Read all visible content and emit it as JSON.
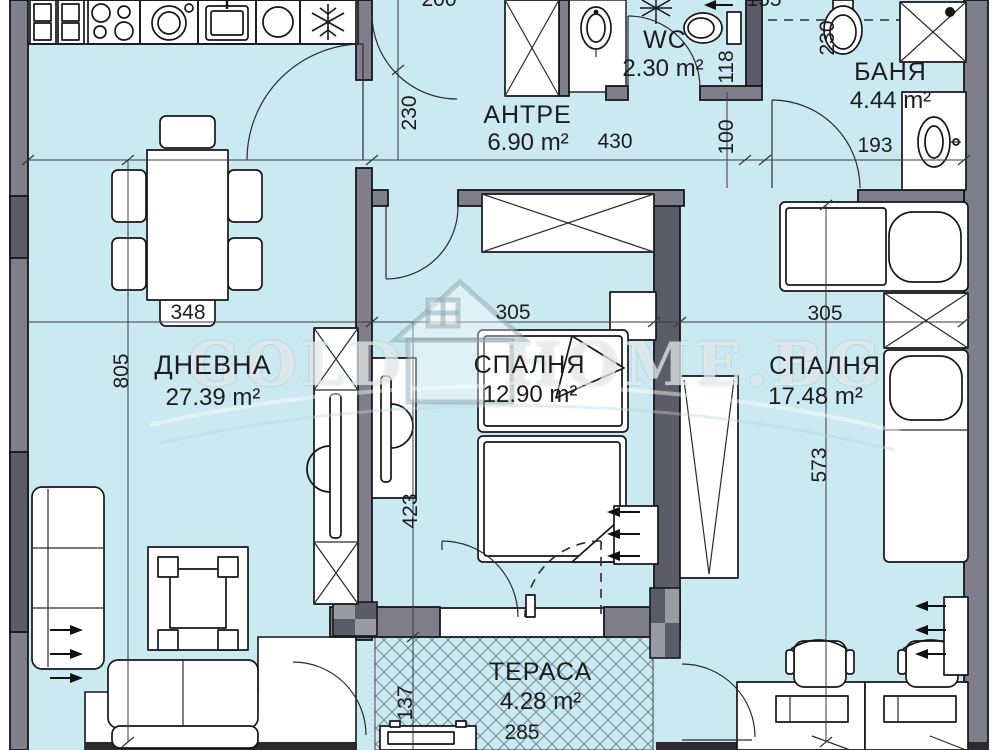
{
  "document": {
    "type": "apartment-floor-plan",
    "language": "bg"
  },
  "watermark": {
    "left": "GOLD",
    "right": "HOME.BG",
    "icon": "house-logo"
  },
  "rooms": [
    {
      "name": "АНТРЕ",
      "area": "6.90 m²"
    },
    {
      "name": "WC",
      "area": "2.30 m²"
    },
    {
      "name": "БАНЯ",
      "area": "4.44 m²"
    },
    {
      "name": "ДНЕВНА",
      "area": "27.39 m²"
    },
    {
      "name": "СПАЛНЯ",
      "area": "12.90 m²"
    },
    {
      "name": "СПАЛНЯ",
      "area": "17.48 m²"
    },
    {
      "name": "ТЕРАСА",
      "area": "4.28 m²"
    }
  ],
  "dimensions_cm": {
    "top_edge_partial": "200",
    "top_right_partial": "155",
    "hall_depth": "230",
    "hall_width": "430",
    "wc_width": "118",
    "corridor_width": "100",
    "bath_entry": "193",
    "bath_toilet_side": "230",
    "living_depth": "805",
    "dining_table": "348",
    "bedroom1_width": "305",
    "bedroom2_width": "305",
    "bedroom1_depth": "423",
    "bedroom2_depth": "573",
    "terrace_depth": "137",
    "terrace_width": "285"
  },
  "palette": {
    "floor": "#cae9f0",
    "wall": "#7f7f8b",
    "wall_dark": "#5c5c68",
    "outline": "#16161a"
  }
}
